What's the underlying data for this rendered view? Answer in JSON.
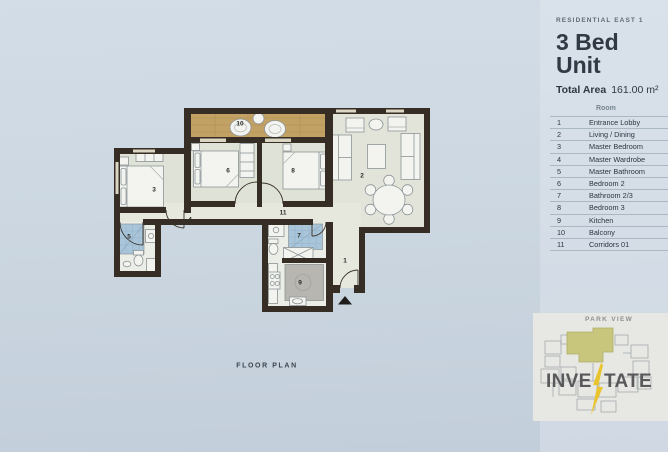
{
  "header": {
    "project": "RESIDENTIAL EAST 1",
    "unit_title": "3 Bed Unit",
    "total_area_label": "Total Area",
    "total_area_value": "161.00 m²"
  },
  "legend": {
    "header": "Room",
    "rows": [
      {
        "num": "1",
        "name": "Entrance Lobby"
      },
      {
        "num": "2",
        "name": "Living / Dining"
      },
      {
        "num": "3",
        "name": "Master Bedroom"
      },
      {
        "num": "4",
        "name": "Master Wardrobe"
      },
      {
        "num": "5",
        "name": "Master Bathroom"
      },
      {
        "num": "6",
        "name": "Bedroom 2"
      },
      {
        "num": "7",
        "name": "Bathroom 2/3"
      },
      {
        "num": "8",
        "name": "Bedroom 3"
      },
      {
        "num": "9",
        "name": "Kitchen"
      },
      {
        "num": "10",
        "name": "Balcony"
      },
      {
        "num": "11",
        "name": "Corridors 01"
      }
    ]
  },
  "plan": {
    "caption": "FLOOR PLAN",
    "labels": {
      "n1": "1",
      "n2": "2",
      "n3": "3",
      "n4": "4",
      "n5": "5",
      "n6": "6",
      "n7": "7",
      "n8": "8",
      "n9": "9",
      "n10": "10",
      "n11": "11"
    }
  },
  "minimap": {
    "title": "PARK VIEW",
    "logo_left": "INVE",
    "logo_right": "TATE"
  },
  "palette": {
    "wall": "#362e24",
    "wood_floor": "#c2a165",
    "room_floor": "#e0e3d6",
    "tile": "#a9c5da",
    "unit_highlight": "#c8c67c",
    "logo_bolt": "#e9c42f",
    "page_background": "#ccd7e1"
  }
}
